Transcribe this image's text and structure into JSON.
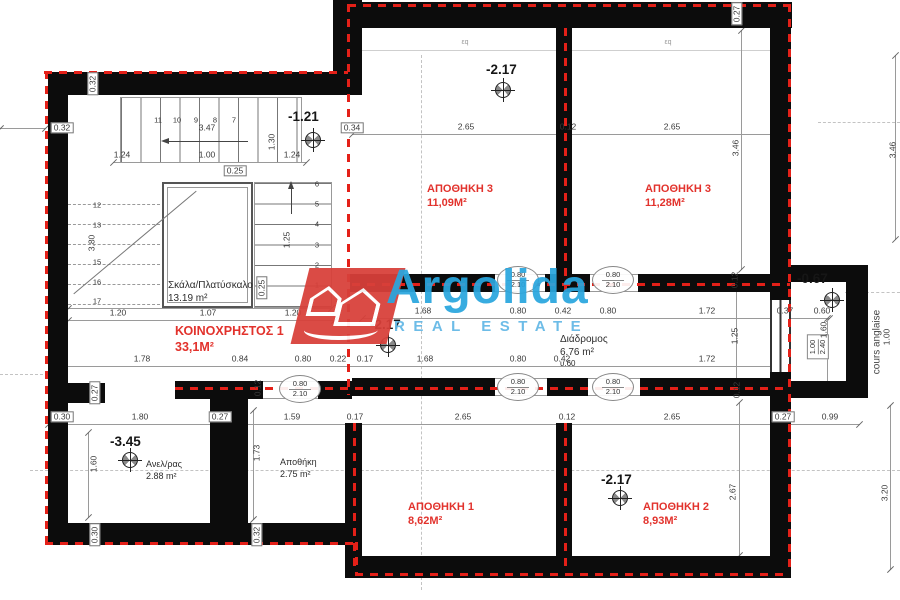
{
  "watermark": {
    "brand": "Argolida",
    "tagline": "REAL ESTATE",
    "brand_color": "#2aa6de",
    "logo_color": "#d8403a"
  },
  "side_label": {
    "text": "cours anglaise"
  },
  "window_marker": {
    "top": "1.00",
    "bottom": "2.40"
  },
  "door_marker": {
    "top": "0.80",
    "bottom": "2.10",
    "positions": [
      {
        "x": 518,
        "y": 280
      },
      {
        "x": 613,
        "y": 280
      },
      {
        "x": 300,
        "y": 389
      },
      {
        "x": 518,
        "y": 387
      },
      {
        "x": 613,
        "y": 387
      }
    ]
  },
  "rooms": [
    {
      "name": "ΑΠΟΘΗΚΗ 3",
      "area": "11,09Μ²",
      "x": 427,
      "y": 182,
      "cls": ""
    },
    {
      "name": "ΑΠΟΘΗΚΗ 3",
      "area": "11,28Μ²",
      "x": 645,
      "y": 182,
      "cls": ""
    },
    {
      "name": "ΚΟΙΝΟΧΡΗΣΤΟΣ 1",
      "area": "33,1Μ²",
      "x": 175,
      "y": 323,
      "cls": "big"
    },
    {
      "name": "ΑΠΟΘΗΚΗ 1",
      "area": "8,62Μ²",
      "x": 408,
      "y": 500,
      "cls": ""
    },
    {
      "name": "ΑΠΟΘΗΚΗ 2",
      "area": "8,93Μ²",
      "x": 643,
      "y": 500,
      "cls": ""
    },
    {
      "name": "Σκάλα/Πλατύσκαλο",
      "area": "13.19 m²",
      "x": 168,
      "y": 279,
      "cls": "blk"
    },
    {
      "name": "Ανελ/ρας",
      "area": "2.88 m²",
      "x": 146,
      "y": 459,
      "cls": "blk sm"
    },
    {
      "name": "Αποθήκη",
      "area": "2.75 m²",
      "x": 280,
      "y": 457,
      "cls": "blk sm"
    },
    {
      "name": "Διάδρομος",
      "area": "6.76 m²",
      "sub": "υ.60",
      "x": 560,
      "y": 333,
      "cls": "blk"
    }
  ],
  "levels": [
    {
      "v": "-1.21",
      "tx": 288,
      "ty": 109,
      "mx": 313,
      "my": 140
    },
    {
      "v": "-2.17",
      "tx": 486,
      "ty": 62,
      "mx": 503,
      "my": 90
    },
    {
      "v": "-2.17",
      "tx": 370,
      "ty": 317,
      "mx": 388,
      "my": 345
    },
    {
      "v": "-3.45",
      "tx": 110,
      "ty": 434,
      "mx": 130,
      "my": 460
    },
    {
      "v": "-2.17",
      "tx": 601,
      "ty": 472,
      "mx": 620,
      "my": 498
    },
    {
      "v": "-0.67",
      "tx": 797,
      "ty": 271,
      "mx": 832,
      "my": 300
    }
  ],
  "stairs": {
    "top_numbers": [
      "11",
      "10",
      "9",
      "8",
      "7"
    ],
    "right_numbers": [
      "6",
      "5",
      "4",
      "3",
      "2",
      "1"
    ],
    "left_numbers": [
      "12",
      "13",
      "15",
      "16",
      "17"
    ]
  },
  "dimensions": [
    {
      "t": "0.27",
      "x": 737,
      "y": 14,
      "r": 1,
      "b": 1
    },
    {
      "t": "2.65",
      "x": 466,
      "y": 127
    },
    {
      "t": "0.12",
      "x": 568,
      "y": 127
    },
    {
      "t": "2.65",
      "x": 672,
      "y": 127
    },
    {
      "t": "0.34",
      "x": 352,
      "y": 128,
      "b": 1
    },
    {
      "t": "3.46",
      "x": 736,
      "y": 148,
      "r": 1
    },
    {
      "t": "3.46",
      "x": 893,
      "y": 150,
      "r": 1
    },
    {
      "t": "εq",
      "x": 465,
      "y": 43,
      "s": 1
    },
    {
      "t": "εq",
      "x": 668,
      "y": 43,
      "s": 1
    },
    {
      "t": "0.32",
      "x": 93,
      "y": 84,
      "r": 1,
      "b": 1
    },
    {
      "t": "0.32",
      "x": 62,
      "y": 128,
      "b": 1
    },
    {
      "t": "3.47",
      "x": 207,
      "y": 128
    },
    {
      "t": "1.24",
      "x": 122,
      "y": 155
    },
    {
      "t": "1.00",
      "x": 207,
      "y": 155
    },
    {
      "t": "0.25",
      "x": 235,
      "y": 171,
      "b": 1
    },
    {
      "t": "1.30",
      "x": 272,
      "y": 142,
      "r": 1
    },
    {
      "t": "1.24",
      "x": 292,
      "y": 155
    },
    {
      "t": "1.25",
      "x": 287,
      "y": 240,
      "r": 1
    },
    {
      "t": "0.25",
      "x": 262,
      "y": 288,
      "r": 1,
      "b": 1
    },
    {
      "t": "3.80",
      "x": 92,
      "y": 243,
      "r": 1
    },
    {
      "t": "1.20",
      "x": 118,
      "y": 313
    },
    {
      "t": "1.07",
      "x": 208,
      "y": 313
    },
    {
      "t": "1.20",
      "x": 293,
      "y": 313
    },
    {
      "t": "1.68",
      "x": 423,
      "y": 311
    },
    {
      "t": "0.80",
      "x": 518,
      "y": 311
    },
    {
      "t": "0.42",
      "x": 563,
      "y": 311
    },
    {
      "t": "0.80",
      "x": 608,
      "y": 311
    },
    {
      "t": "1.72",
      "x": 707,
      "y": 311
    },
    {
      "t": "0.37",
      "x": 785,
      "y": 311
    },
    {
      "t": "0.60",
      "x": 822,
      "y": 311
    },
    {
      "t": "1.60",
      "x": 824,
      "y": 330,
      "r": 1
    },
    {
      "t": "1.00",
      "x": 887,
      "y": 337,
      "r": 1
    },
    {
      "t": "0.12",
      "x": 735,
      "y": 280,
      "r": 1
    },
    {
      "t": "1.25",
      "x": 735,
      "y": 336,
      "r": 1
    },
    {
      "t": "0.12",
      "x": 737,
      "y": 390,
      "r": 1
    },
    {
      "t": "1.78",
      "x": 142,
      "y": 359
    },
    {
      "t": "0.84",
      "x": 240,
      "y": 359
    },
    {
      "t": "0.80",
      "x": 303,
      "y": 359
    },
    {
      "t": "0.22",
      "x": 338,
      "y": 359
    },
    {
      "t": "0.17",
      "x": 365,
      "y": 359
    },
    {
      "t": "1.68",
      "x": 425,
      "y": 359
    },
    {
      "t": "0.80",
      "x": 518,
      "y": 359
    },
    {
      "t": "0.42",
      "x": 562,
      "y": 359
    },
    {
      "t": "1.72",
      "x": 707,
      "y": 359
    },
    {
      "t": "0.12",
      "x": 258,
      "y": 388,
      "r": 1
    },
    {
      "t": "0.30",
      "x": 62,
      "y": 417,
      "b": 1
    },
    {
      "t": "1.80",
      "x": 140,
      "y": 417
    },
    {
      "t": "0.27",
      "x": 220,
      "y": 417,
      "b": 1
    },
    {
      "t": "1.59",
      "x": 292,
      "y": 417
    },
    {
      "t": "0.17",
      "x": 355,
      "y": 417
    },
    {
      "t": "2.65",
      "x": 463,
      "y": 417
    },
    {
      "t": "0.12",
      "x": 567,
      "y": 417
    },
    {
      "t": "2.65",
      "x": 672,
      "y": 417
    },
    {
      "t": "0.27",
      "x": 783,
      "y": 417,
      "b": 1
    },
    {
      "t": "0.99",
      "x": 830,
      "y": 417
    },
    {
      "t": "0.27",
      "x": 95,
      "y": 393,
      "r": 1,
      "b": 1
    },
    {
      "t": "1.60",
      "x": 94,
      "y": 464,
      "r": 1
    },
    {
      "t": "1.73",
      "x": 257,
      "y": 453,
      "r": 1
    },
    {
      "t": "2.67",
      "x": 733,
      "y": 492,
      "r": 1
    },
    {
      "t": "3.20",
      "x": 885,
      "y": 493,
      "r": 1
    },
    {
      "t": "0.30",
      "x": 95,
      "y": 535,
      "r": 1,
      "b": 1
    },
    {
      "t": "0.32",
      "x": 257,
      "y": 535,
      "r": 1,
      "b": 1
    }
  ]
}
